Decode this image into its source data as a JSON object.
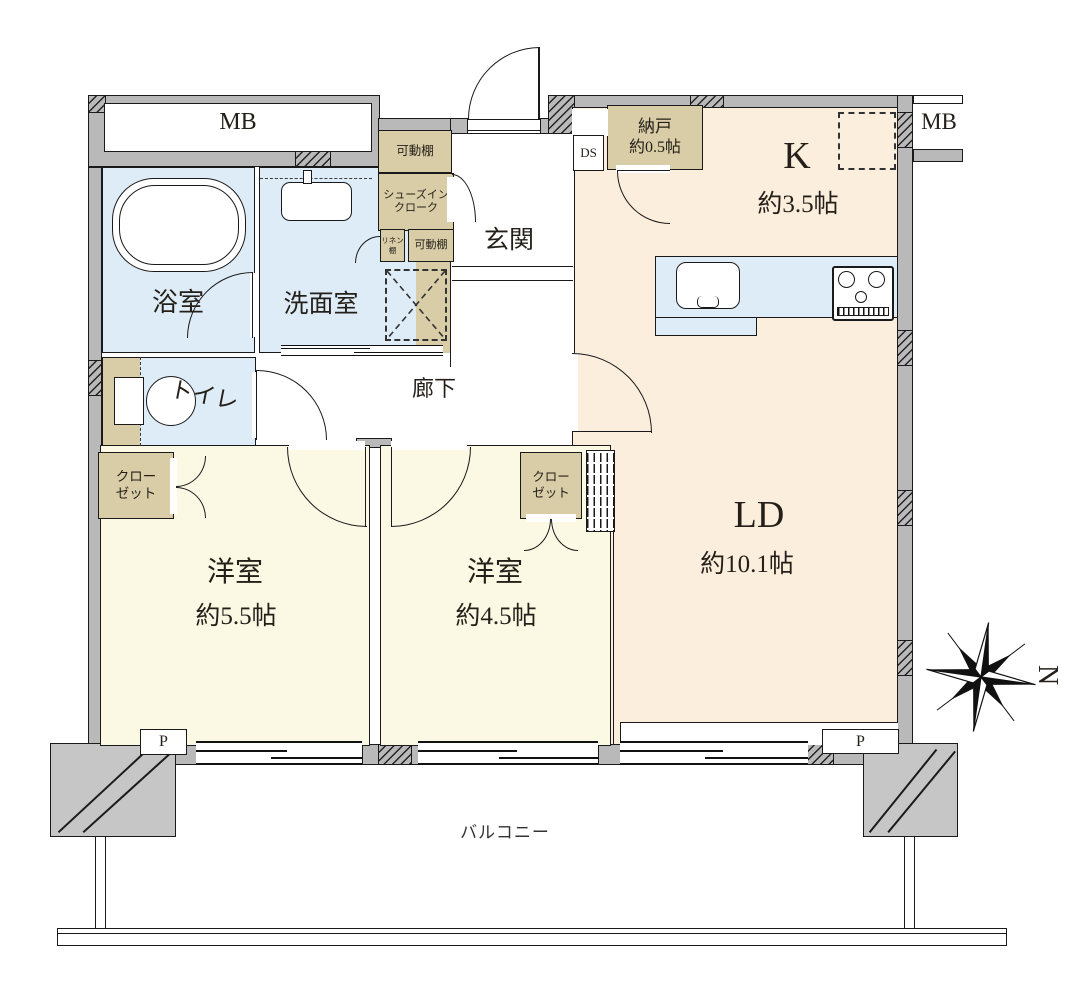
{
  "colors": {
    "wall_gray": "#b9b9b9",
    "column_gray": "#c6c6c6",
    "peach": "#fbeedd",
    "cream": "#fbf9e4",
    "light_blue": "#ddecf7",
    "tan": "#d8cda6",
    "line": "#1a1a1a"
  },
  "rooms": {
    "kitchen": {
      "label": "K",
      "size": "約3.5帖"
    },
    "living_dining": {
      "label": "LD",
      "size": "約10.1帖"
    },
    "bedroom1": {
      "label": "洋室",
      "size": "約5.5帖"
    },
    "bedroom2": {
      "label": "洋室",
      "size": "約4.5帖"
    },
    "storage": {
      "label": "納戸",
      "size": "約0.5帖"
    },
    "bathroom": {
      "label": "浴室"
    },
    "washroom": {
      "label": "洗面室"
    },
    "toilet": {
      "label": "トイレ"
    },
    "entrance": {
      "label": "玄関"
    },
    "corridor": {
      "label": "廊下"
    },
    "balcony": {
      "label": "バルコニー"
    }
  },
  "closets": {
    "closet_left": "クローゼット",
    "closet_right": "クローゼット",
    "shoes_in_cloak": "シューズインクローク",
    "movable_shelf_top": "可動棚",
    "movable_shelf_mid": "可動棚",
    "linen_shelf": "リネン棚"
  },
  "labels": {
    "mb_left": "MB",
    "mb_right": "MB",
    "ds": "DS",
    "pipe_left": "P",
    "pipe_right": "P",
    "north": "N"
  }
}
